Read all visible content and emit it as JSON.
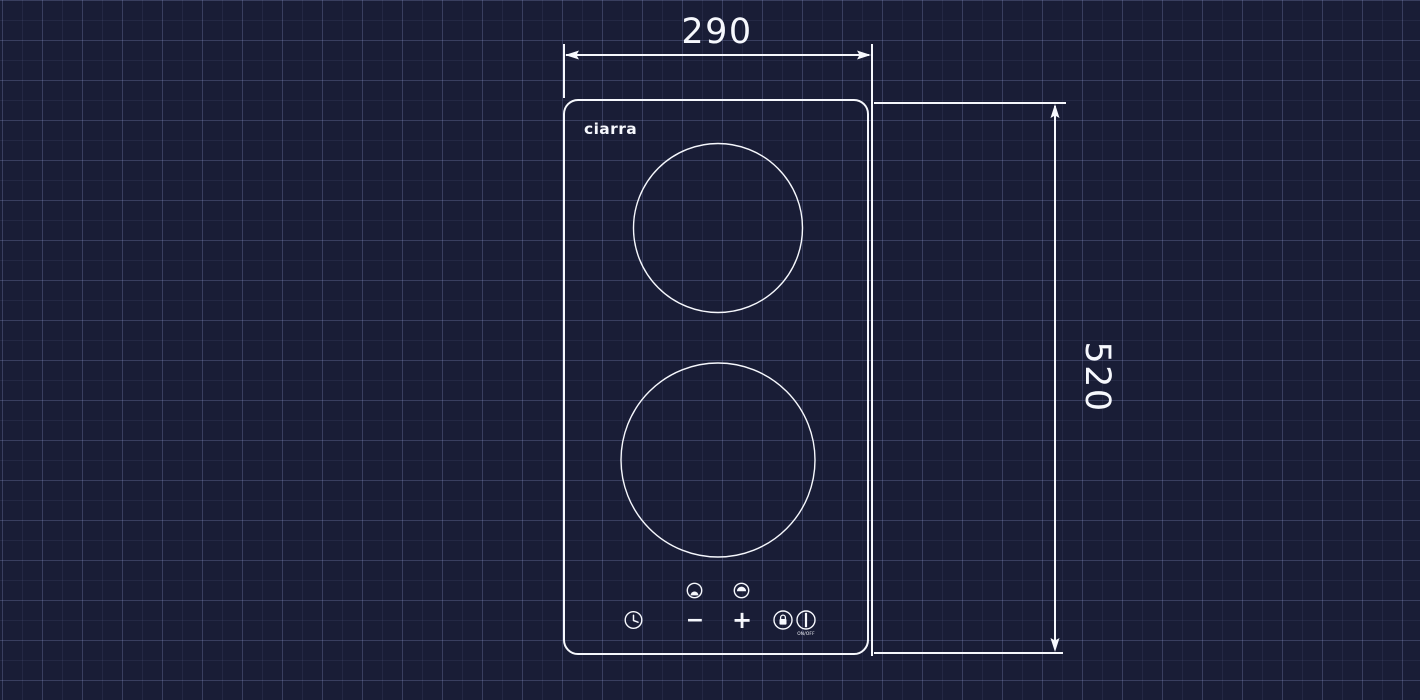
{
  "colors": {
    "background": "#191d36",
    "grid_line_minor": "rgba(148,162,216,0.09)",
    "grid_line_major": "rgba(158,172,226,0.17)",
    "drawing_stroke": "#f6f8fd",
    "text": "#f6f8fd"
  },
  "diagram": {
    "type": "product-dimension-drawing",
    "subject": "two-zone domino hob, top view on blueprint grid",
    "brand_logo": "ciarra",
    "dimensions": {
      "width_label": "290",
      "height_label": "520"
    },
    "cooking_zones": [
      {
        "name": "rear-zone-circle"
      },
      {
        "name": "front-zone-circle"
      }
    ],
    "control_panel": {
      "zone_indicators": [
        "front-zone-indicator",
        "rear-zone-indicator"
      ],
      "timer_icon": "timer-clock",
      "minus_label": "−",
      "plus_label": "+",
      "lock_icon": "child-lock",
      "power_icon": "power",
      "power_label": "ON/OFF"
    }
  }
}
